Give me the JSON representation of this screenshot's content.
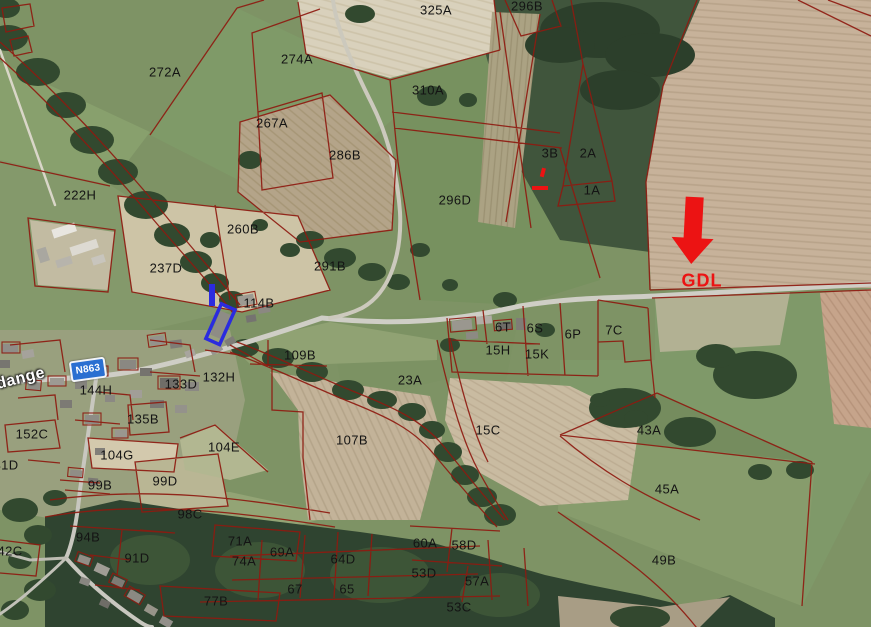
{
  "map": {
    "title": "Aerial cadastral parcel map with highlighted parcel, road shield and GDL arrow marker",
    "colors": {
      "cadastral_line": "#8e1a10",
      "marker_red": "#ec1313",
      "marker_blue": "#2b2bdf",
      "shield_blue": "#2a6fd1",
      "label_text": "#141414"
    },
    "road_shield": {
      "label": "N863"
    },
    "place_label": {
      "text": "dange"
    },
    "markers": {
      "gdl_label": "GDL",
      "red_arrow": "arrow-pointing-down",
      "red_ticks": "two small red dashes near parcel 3B",
      "highlighted_parcel": "blue outlined parcel with blue bar pointer"
    },
    "parcel_labels": [
      {
        "text": "325A",
        "x": 436,
        "y": 10
      },
      {
        "text": "296B",
        "x": 527,
        "y": 6
      },
      {
        "text": "274A",
        "x": 297,
        "y": 59
      },
      {
        "text": "272A",
        "x": 165,
        "y": 72
      },
      {
        "text": "310A",
        "x": 428,
        "y": 90
      },
      {
        "text": "267A",
        "x": 272,
        "y": 123
      },
      {
        "text": "286B",
        "x": 345,
        "y": 155
      },
      {
        "text": "3B",
        "x": 550,
        "y": 153
      },
      {
        "text": "2A",
        "x": 588,
        "y": 153
      },
      {
        "text": "1A",
        "x": 592,
        "y": 190
      },
      {
        "text": "296D",
        "x": 455,
        "y": 200
      },
      {
        "text": "222H",
        "x": 80,
        "y": 195
      },
      {
        "text": "260B",
        "x": 243,
        "y": 229
      },
      {
        "text": "237D",
        "x": 166,
        "y": 268
      },
      {
        "text": "291B",
        "x": 330,
        "y": 266
      },
      {
        "text": "114B",
        "x": 259,
        "y": 303
      },
      {
        "text": "109B",
        "x": 300,
        "y": 355
      },
      {
        "text": "6T",
        "x": 503,
        "y": 327
      },
      {
        "text": "6S",
        "x": 535,
        "y": 328
      },
      {
        "text": "6P",
        "x": 573,
        "y": 334
      },
      {
        "text": "7C",
        "x": 614,
        "y": 330
      },
      {
        "text": "15H",
        "x": 498,
        "y": 350
      },
      {
        "text": "15K",
        "x": 537,
        "y": 354
      },
      {
        "text": "23A",
        "x": 410,
        "y": 380
      },
      {
        "text": "132H",
        "x": 219,
        "y": 377
      },
      {
        "text": "133D",
        "x": 181,
        "y": 384
      },
      {
        "text": "144H",
        "x": 96,
        "y": 390
      },
      {
        "text": "135B",
        "x": 143,
        "y": 419
      },
      {
        "text": "152C",
        "x": 32,
        "y": 434
      },
      {
        "text": "104E",
        "x": 224,
        "y": 447
      },
      {
        "text": "107B",
        "x": 352,
        "y": 440
      },
      {
        "text": "15C",
        "x": 488,
        "y": 430
      },
      {
        "text": "43A",
        "x": 649,
        "y": 430
      },
      {
        "text": "104G",
        "x": 117,
        "y": 455
      },
      {
        "text": "41D",
        "x": 6,
        "y": 465
      },
      {
        "text": "99D",
        "x": 165,
        "y": 481
      },
      {
        "text": "99B",
        "x": 100,
        "y": 485
      },
      {
        "text": "45A",
        "x": 667,
        "y": 489
      },
      {
        "text": "98C",
        "x": 190,
        "y": 514
      },
      {
        "text": "94B",
        "x": 88,
        "y": 537
      },
      {
        "text": "71A",
        "x": 240,
        "y": 541
      },
      {
        "text": "60A",
        "x": 425,
        "y": 543
      },
      {
        "text": "58D",
        "x": 464,
        "y": 545
      },
      {
        "text": "42C",
        "x": 10,
        "y": 551
      },
      {
        "text": "69A",
        "x": 282,
        "y": 552
      },
      {
        "text": "91D",
        "x": 137,
        "y": 558
      },
      {
        "text": "49B",
        "x": 664,
        "y": 560
      },
      {
        "text": "74A",
        "x": 244,
        "y": 561
      },
      {
        "text": "64D",
        "x": 343,
        "y": 559
      },
      {
        "text": "53D",
        "x": 424,
        "y": 573
      },
      {
        "text": "57A",
        "x": 477,
        "y": 581
      },
      {
        "text": "67",
        "x": 295,
        "y": 589
      },
      {
        "text": "65",
        "x": 347,
        "y": 589
      },
      {
        "text": "77B",
        "x": 216,
        "y": 601
      },
      {
        "text": "53C",
        "x": 459,
        "y": 607
      }
    ]
  }
}
